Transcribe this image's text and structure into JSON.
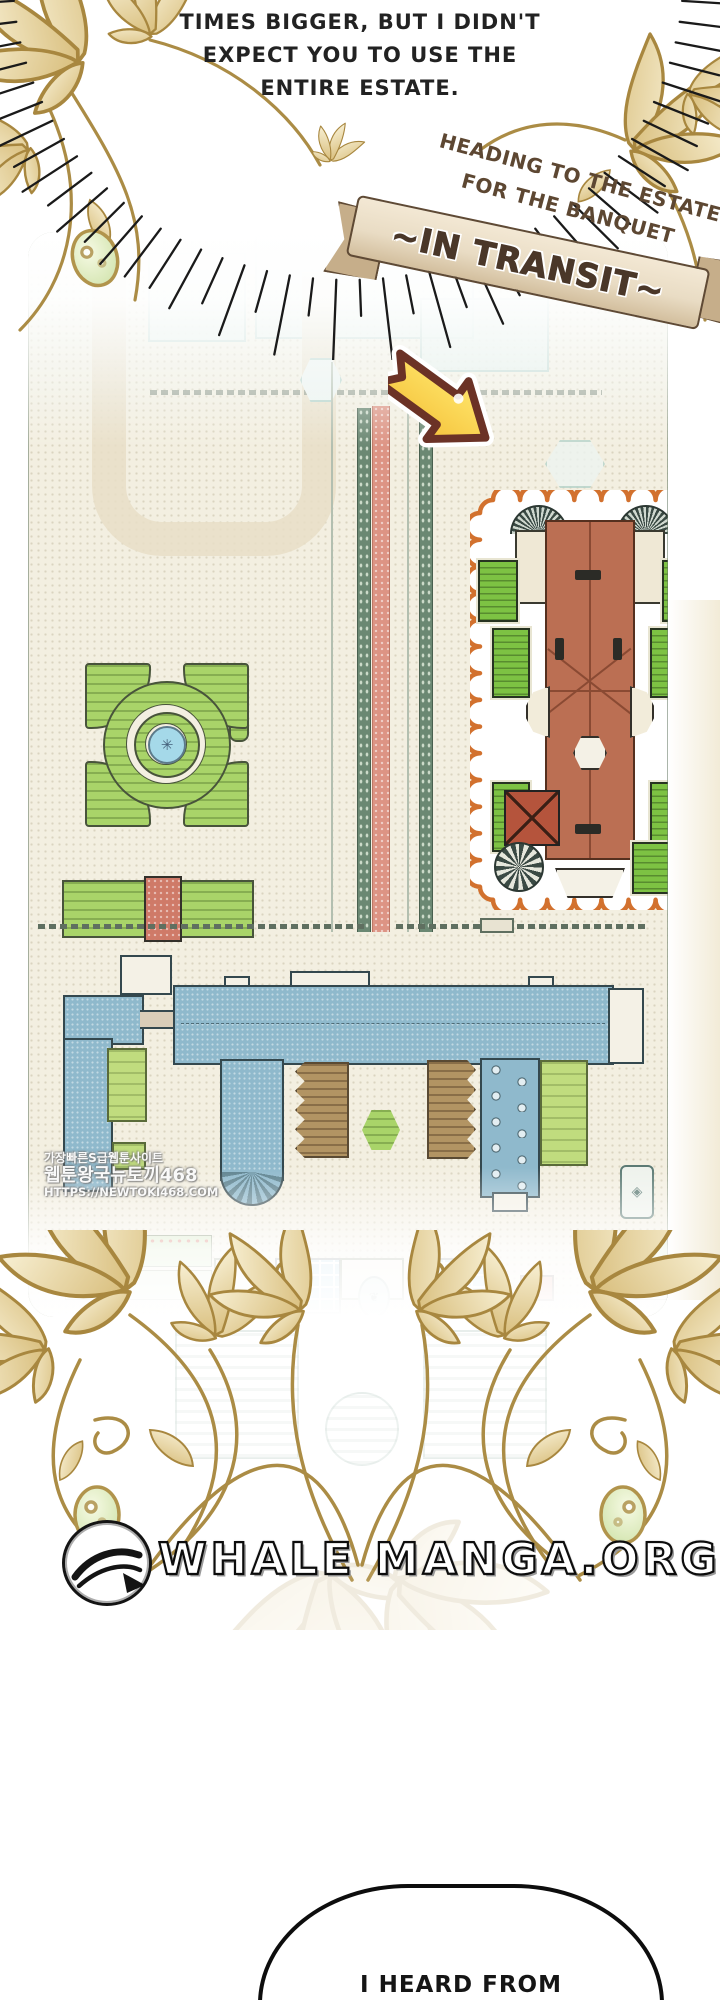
{
  "speech_bubble_top": {
    "lines": [
      "TIMES BIGGER, BUT I DIDN'T",
      "EXPECT YOU TO USE THE",
      "ENTIRE ESTATE."
    ]
  },
  "caption": {
    "line1": "HEADING TO THE ESTATE",
    "line2": "FOR THE BANQUET"
  },
  "banner": {
    "label": "~IN TRANSIT~"
  },
  "watermark": {
    "line1": "가장빠른S급웹툰사이트",
    "line2": "웹툰왕국뉴토끼468",
    "line3": "HTTPS://NEWTOKI468.COM"
  },
  "logo": {
    "site_name": "WHALE MANGA.ORG"
  },
  "speech_bubble_bottom": {
    "line1": "I HEARD FROM"
  },
  "colors": {
    "caption_text": "#5d4732",
    "ribbon_fill": "#e9dcc4",
    "ribbon_outline": "#5f4a35",
    "map_background": "#f3efe1",
    "highlight_outline": "#d2712e",
    "arrow_fill": "#ffd94e",
    "arrow_outline": "#6b3226",
    "mansion_roof": "#bb6f53",
    "garden_green": "#a9d469",
    "roof_garden_green": "#7dc243",
    "complex_blue": "#8fb9cc",
    "pond_blue": "#a5d8e8",
    "road_pink": "#dd9484",
    "lily_gold": "#c9ab62"
  }
}
